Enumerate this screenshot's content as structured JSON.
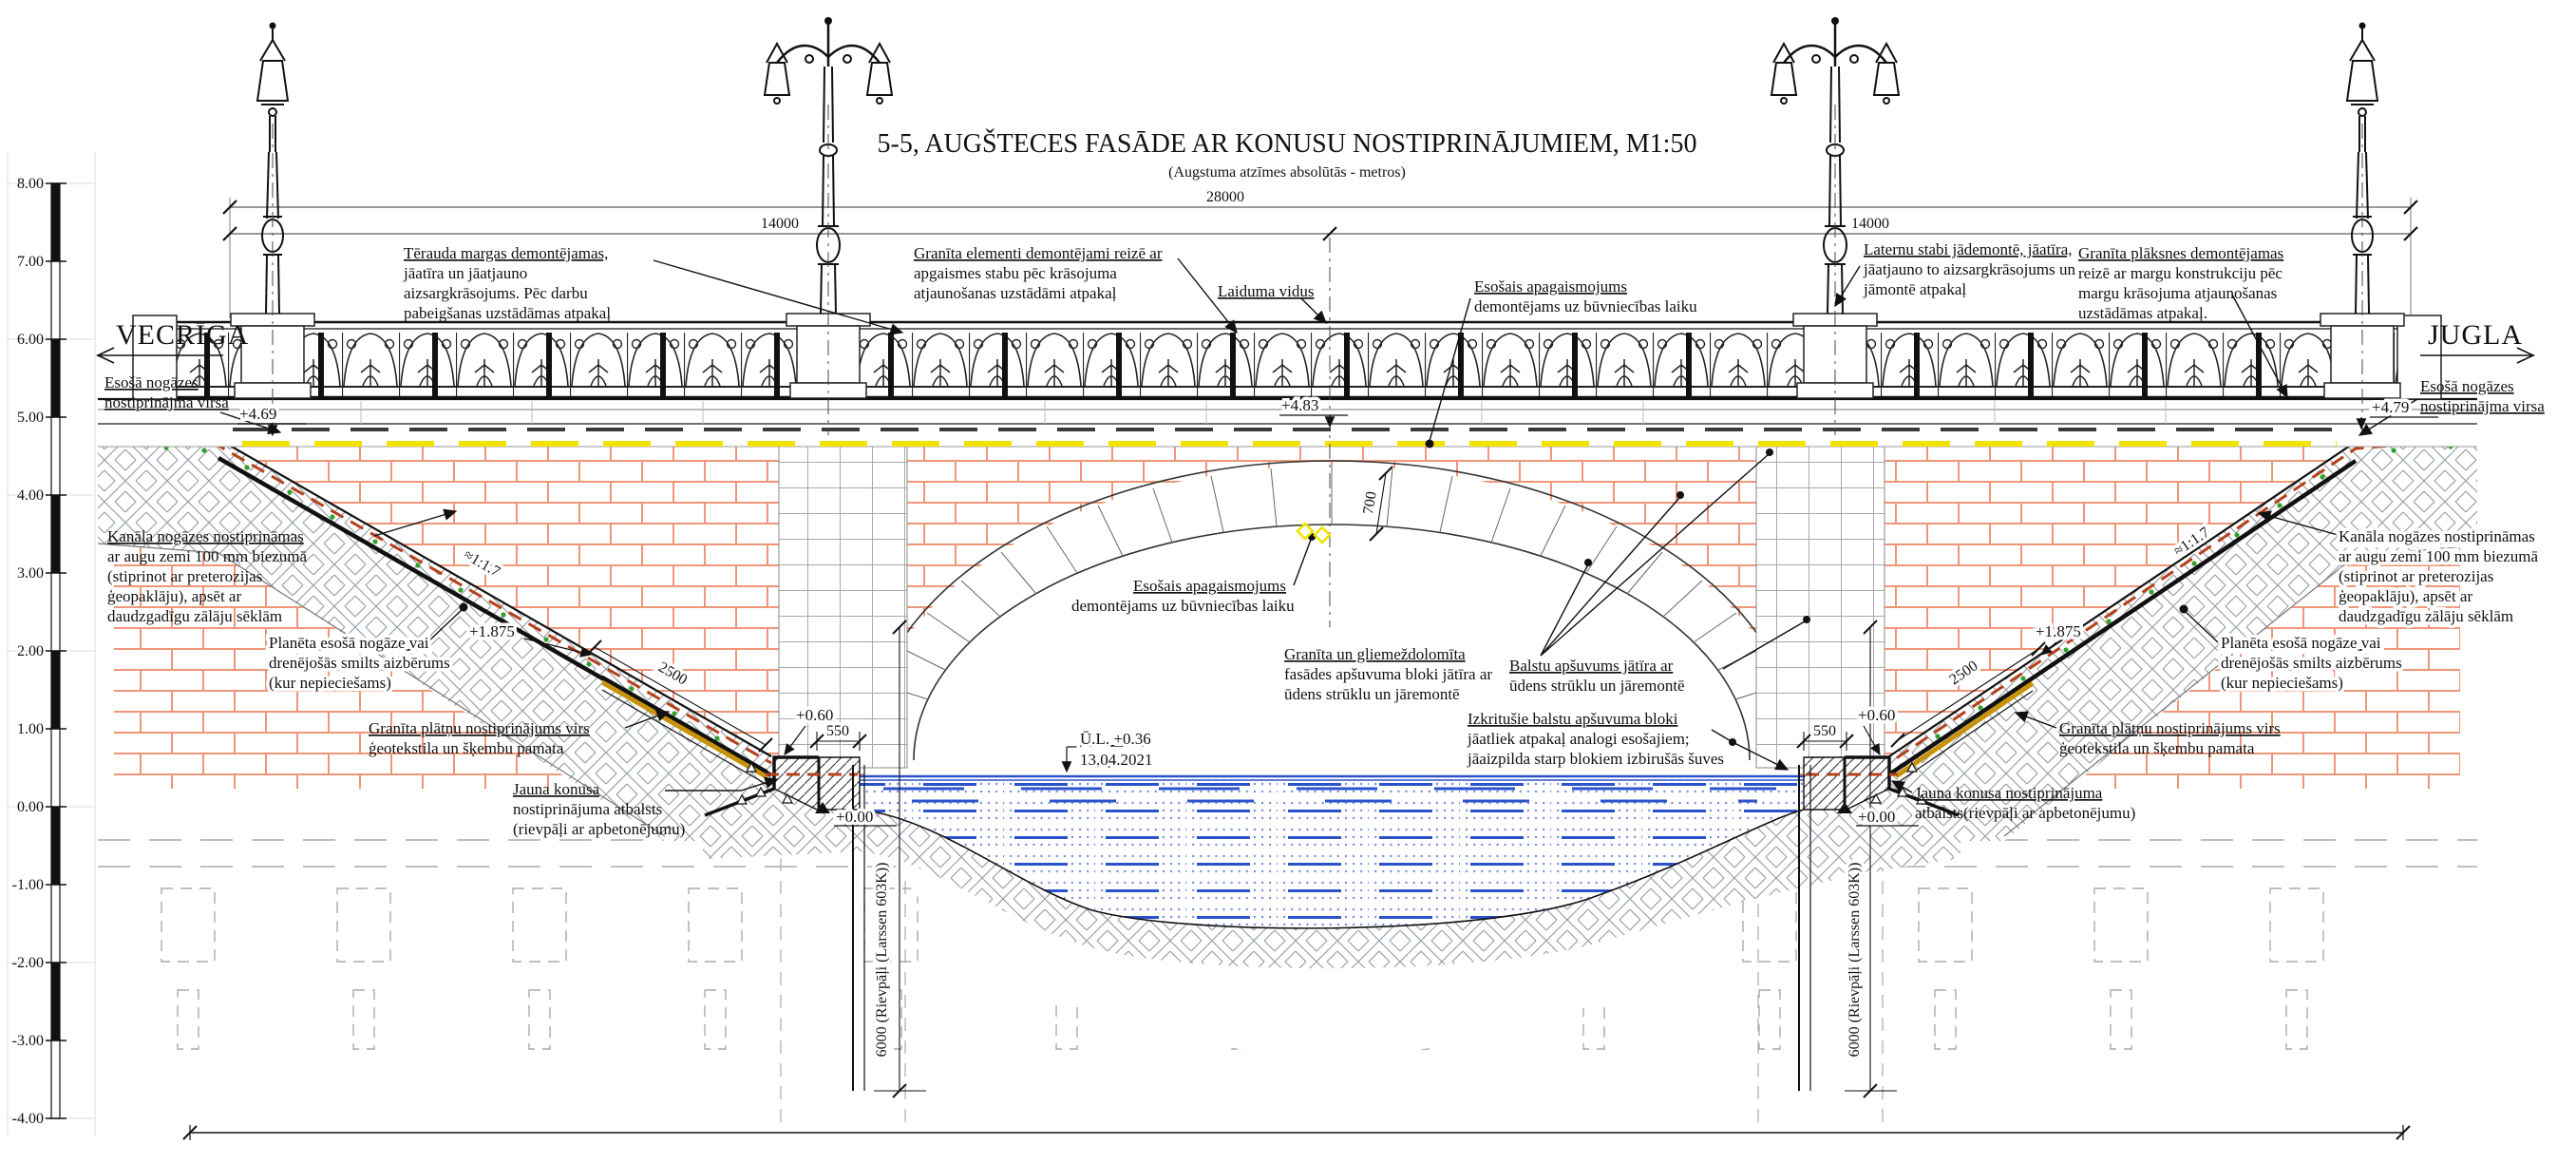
{
  "title": "5-5, AUGŠTECES FASĀDE AR KONUSU NOSTIPRINĀJUMIEM, M1:50",
  "subtitle": "(Augstuma atzīmes absolūtās - metros)",
  "directions": {
    "left": "VECRĪGA",
    "right": "JUGLA"
  },
  "scale_bar": {
    "labels": [
      "8.00",
      "7.00",
      "6.00",
      "5.00",
      "4.00",
      "3.00",
      "2.00",
      "1.00",
      "0.00",
      "-1.00",
      "-2.00",
      "-3.00",
      "-4.00"
    ]
  },
  "dimensions": {
    "total": "28000",
    "half_left": "14000",
    "half_right": "14000",
    "arch_ring": "700",
    "slab_left": "2500",
    "slab_right": "2500",
    "toe_left": "550",
    "toe_right": "550",
    "sheet_pile_left": "6000 (Rievpāļi (Larssen 603K))",
    "sheet_pile_right": "6000 (Rievpāļi (Larssen 603K))",
    "slope_ratio_left": "≈1:1.7",
    "slope_ratio_right": "≈1:1.7"
  },
  "elevations": {
    "deck_left": "+4.69",
    "deck_mid": "+4.83",
    "deck_right": "+4.79",
    "slab_top_left": "+1.875",
    "slab_top_right": "+1.875",
    "toe_top_left": "+0.60",
    "toe_top_right": "+0.60",
    "zero_left": "+0.00",
    "zero_right": "+0.00"
  },
  "water": {
    "level_label": "Ū.L. +0.36",
    "date": "13.04.2021"
  },
  "callouts": {
    "terauda": {
      "lines": [
        "Tērauda margas demontējamas,",
        "jāatīra un jāatjauno",
        "aizsargkrāsojums. Pēc darbu",
        "pabeigšanas uzstādāmas atpakaļ"
      ]
    },
    "granita_elementi": {
      "lines": [
        "Granīta elementi demontējami reizē ar",
        "apgaismes stabu pēc krāsojuma",
        "atjaunošanas uzstādāmi atpakaļ"
      ]
    },
    "laiduma_vidus": {
      "lines": [
        "Laiduma vidus"
      ]
    },
    "esosais_apg_top": {
      "lines": [
        "Esošais apagaismojums",
        "demontējams uz būvniecības laiku"
      ]
    },
    "laternu": {
      "lines": [
        "Laternu stabi jādemontē, jāatīra,",
        "jāatjauno to aizsargkrāsojums un",
        "jāmontē atpakaļ"
      ]
    },
    "granita_plaksnes": {
      "lines": [
        "Granīta plāksnes demontējamas",
        "reizē ar margu konstrukciju pēc",
        "margu krāsojuma atjaunošanas",
        "uzstādāmas atpakaļ."
      ]
    },
    "esosa_virsa_left": {
      "lines": [
        "Esošā nogāzes",
        "nostiprinājma virsa"
      ]
    },
    "esosa_virsa_right": {
      "lines": [
        "Esošā nogāzes",
        "nostiprinājma virsa"
      ]
    },
    "kanala_left": {
      "lines": [
        "Kanāla nogāzes nostiprināmas",
        "ar augu zemi 100 mm biezumā",
        "(stiprinot ar preterozijas",
        "ģeopaklāju), apsēt ar",
        "daudzgadīgu zālāju sēklām"
      ]
    },
    "kanala_right": {
      "lines": [
        "Kanāla nogāzes nostiprināmas",
        "ar augu zemi 100 mm biezumā",
        "(stiprinot ar preterozijas",
        "ģeopaklāju), apsēt ar",
        "daudzgadīgu zālāju sēklām"
      ]
    },
    "planeta_left": {
      "lines": [
        "Planēta esošā nogāze vai",
        "drenējošās smilts aizbērums",
        "(kur nepieciešams)"
      ]
    },
    "planeta_right": {
      "lines": [
        "Planēta esošā nogāze vai",
        "drenējošās smilts aizbērums",
        "(kur nepieciešams)"
      ]
    },
    "granita_platnu_left": {
      "lines": [
        "Granīta plātņu nostiprinājums virs",
        "ģeotekstila un šķembu pamata"
      ]
    },
    "granita_platnu_right": {
      "lines": [
        "Granīta plātņu nostiprinājums virs",
        "ģeotekstila un šķembu pamata"
      ]
    },
    "jauna_konusa_left": {
      "lines": [
        "Jauna konusa",
        "nostiprinājuma atbalsts",
        "(rievpāļi ar apbetonējumu)"
      ]
    },
    "jauna_konusa_right": {
      "lines": [
        "Jauna konusa nostiprinājuma",
        "atbalsts(rievpāļi ar apbetonējumu)"
      ]
    },
    "esosais_apg_mid": {
      "lines": [
        "Esošais apagaismojums",
        "demontējams uz būvniecības laiku"
      ]
    },
    "gran_gliem": {
      "lines": [
        "Granīta un gliemeždolomīta",
        "fasādes apšuvuma bloki jātīra ar",
        "ūdens strūklu un jāremontē"
      ]
    },
    "balstu": {
      "lines": [
        "Balstu apšuvums jātīra ar",
        "ūdens strūklu un jāremontē"
      ]
    },
    "izkritusie": {
      "lines": [
        "Izkritušie balstu apšuvuma bloki",
        "jāatliek atpakaļ analogi esošajiem;",
        "jāaizpilda starp blokiem izbirušās šuves"
      ]
    }
  },
  "colors": {
    "brick_joint": "#ef9679",
    "lighting_cable": "#f2e400",
    "water_line": "#2a52cc",
    "slope_geomat": "#b5401a",
    "granite_slab": "#c8920a",
    "grass_dots": "#33a02c",
    "hatch_gray": "#98a0a8"
  }
}
